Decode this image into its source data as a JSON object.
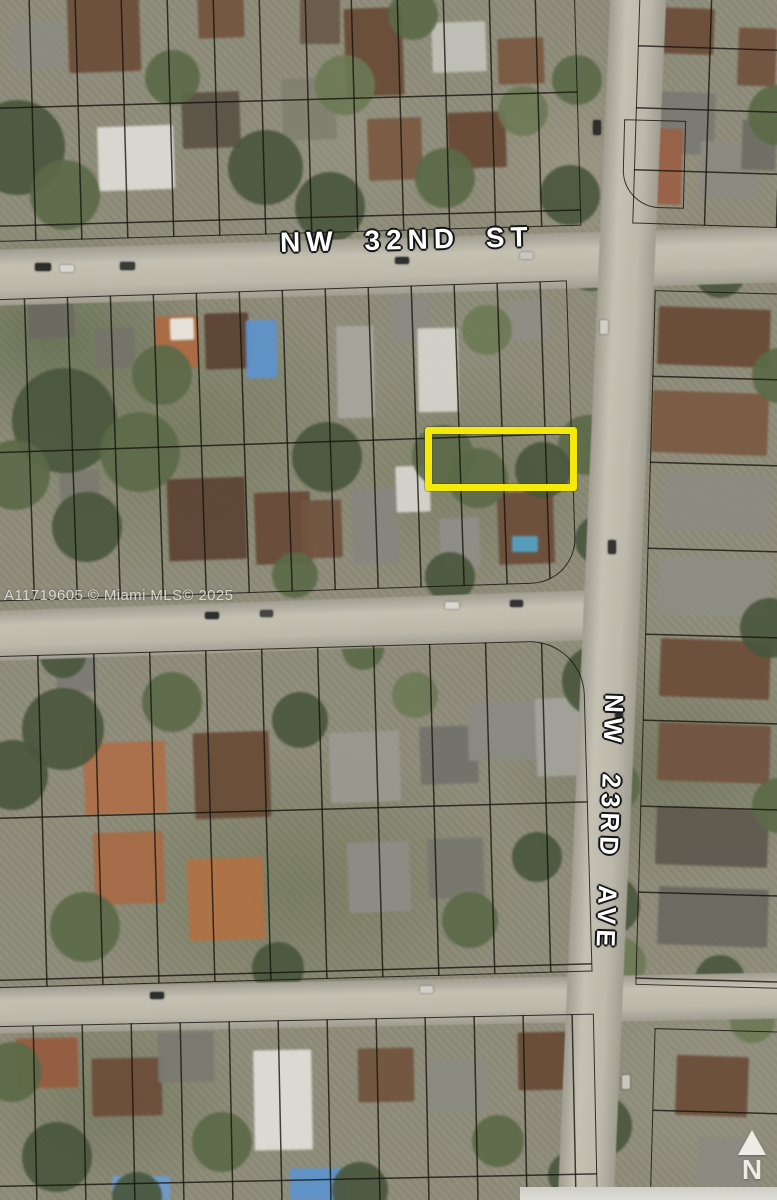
{
  "image": {
    "kind": "aerial-parcel-map",
    "width": 777,
    "height": 1200
  },
  "labels": {
    "street_horizontal": "NW 32ND ST",
    "street_vertical": "NW 23RD AVE",
    "watermark": "A11719605 © Miami MLS© 2025",
    "north_indicator": "N"
  },
  "colors": {
    "highlight_yellow": "#F5E90A",
    "parcel_line": "rgba(20,18,12,0.82)",
    "road_gray": "#bcb9ab",
    "label_white": "#ffffff"
  },
  "highlight": {
    "x": 425,
    "y": 427,
    "w": 152,
    "h": 64,
    "border_px": 7,
    "color": "#F5E90A"
  },
  "scene": {
    "roads": [
      {
        "x": -20,
        "y": 238,
        "w": 820,
        "h": 56,
        "rot": -1.7,
        "vert": false
      },
      {
        "x": -20,
        "y": 600,
        "w": 655,
        "h": 50,
        "rot": -2.0,
        "vert": false
      },
      {
        "x": -20,
        "y": 980,
        "w": 820,
        "h": 46,
        "rot": -1.1,
        "vert": false
      },
      {
        "x": 584,
        "y": -45,
        "w": 56,
        "h": 1290,
        "rot": 2.5,
        "vert": true
      }
    ],
    "blocks": [
      {
        "x": -14,
        "y": -18,
        "w": 592,
        "h": 252,
        "rot": -1.6,
        "v": 46,
        "h2": 118
      },
      {
        "x": 636,
        "y": -14,
        "w": 158,
        "h": 240,
        "rot": 1.8,
        "v": 72,
        "h2": 62
      },
      {
        "x": 623,
        "y": 120,
        "w": 62,
        "h": 88,
        "rot": 1.5,
        "v": 0,
        "h2": 0,
        "rbl": 38
      },
      {
        "x": -14,
        "y": 290,
        "w": 586,
        "h": 302,
        "rot": -1.9,
        "v": 43,
        "h2": 153,
        "rbr": 45
      },
      {
        "x": 645,
        "y": 292,
        "w": 148,
        "h": 695,
        "rot": 1.6,
        "v": 0,
        "h2": 86
      },
      {
        "x": -14,
        "y": 648,
        "w": 602,
        "h": 332,
        "rot": -1.6,
        "v": 56,
        "h2": 162,
        "rtr": 55
      },
      {
        "x": -14,
        "y": 1020,
        "w": 610,
        "h": 200,
        "rot": -1.2,
        "v": 49,
        "h2": 160
      },
      {
        "x": 652,
        "y": 1030,
        "w": 142,
        "h": 185,
        "rot": 1.6,
        "v": 0,
        "h2": 82
      }
    ],
    "houses": [
      {
        "x": 12,
        "y": 22,
        "w": 52,
        "h": 46,
        "c": "#8d8b82",
        "r": -2
      },
      {
        "x": 68,
        "y": -6,
        "w": 72,
        "h": 78,
        "c": "#6e4f38",
        "r": -2
      },
      {
        "x": 98,
        "y": 126,
        "w": 76,
        "h": 64,
        "c": "#dbdad2",
        "r": -2
      },
      {
        "x": 182,
        "y": 92,
        "w": 58,
        "h": 56,
        "c": "#5d5346",
        "r": -2
      },
      {
        "x": 198,
        "y": -4,
        "w": 46,
        "h": 42,
        "c": "#77553c",
        "r": -2
      },
      {
        "x": 282,
        "y": 78,
        "w": 54,
        "h": 62,
        "c": "#82816f",
        "r": -2
      },
      {
        "x": 300,
        "y": -6,
        "w": 40,
        "h": 50,
        "c": "#6b5a49",
        "r": 0
      },
      {
        "x": 345,
        "y": 8,
        "w": 58,
        "h": 88,
        "c": "#6b4c36",
        "r": -2
      },
      {
        "x": 368,
        "y": 118,
        "w": 54,
        "h": 62,
        "c": "#7d5b41",
        "r": -2
      },
      {
        "x": 432,
        "y": 22,
        "w": 54,
        "h": 50,
        "c": "#c2c1b8",
        "r": -2
      },
      {
        "x": 448,
        "y": 112,
        "w": 58,
        "h": 56,
        "c": "#6a4a34",
        "r": -2
      },
      {
        "x": 498,
        "y": 38,
        "w": 46,
        "h": 46,
        "c": "#7c5a40",
        "r": -2
      },
      {
        "x": 652,
        "y": 8,
        "w": 62,
        "h": 46,
        "c": "#6e4e38",
        "r": 2
      },
      {
        "x": 645,
        "y": 92,
        "w": 70,
        "h": 62,
        "c": "#7b7a71",
        "r": 2
      },
      {
        "x": 624,
        "y": 128,
        "w": 58,
        "h": 76,
        "c": "#9d6044",
        "r": 2
      },
      {
        "x": 738,
        "y": 28,
        "w": 38,
        "h": 58,
        "c": "#74533c",
        "r": 2
      },
      {
        "x": 700,
        "y": 142,
        "w": 58,
        "h": 56,
        "c": "#8b8a80",
        "r": 2
      },
      {
        "x": 742,
        "y": 120,
        "w": 34,
        "h": 50,
        "c": "#6f6e64",
        "r": 2
      },
      {
        "x": 28,
        "y": 298,
        "w": 46,
        "h": 40,
        "c": "#6b6a60",
        "r": -2
      },
      {
        "x": 95,
        "y": 328,
        "w": 40,
        "h": 40,
        "c": "#757468",
        "r": -2
      },
      {
        "x": 155,
        "y": 316,
        "w": 44,
        "h": 52,
        "c": "#b06a3f",
        "r": -2
      },
      {
        "x": 170,
        "y": 318,
        "w": 24,
        "h": 22,
        "c": "#e9e7df",
        "r": -2
      },
      {
        "x": 205,
        "y": 313,
        "w": 44,
        "h": 56,
        "c": "#5e4432",
        "r": -2
      },
      {
        "x": 246,
        "y": 320,
        "w": 31,
        "h": 58,
        "c": "#5b93cf",
        "r": -1
      },
      {
        "x": 337,
        "y": 326,
        "w": 37,
        "h": 92,
        "c": "#a7a69c",
        "r": -1
      },
      {
        "x": 390,
        "y": 298,
        "w": 40,
        "h": 44,
        "c": "#8b8a82",
        "r": -2
      },
      {
        "x": 418,
        "y": 328,
        "w": 40,
        "h": 84,
        "c": "#d3d2ca",
        "r": -1
      },
      {
        "x": 508,
        "y": 300,
        "w": 40,
        "h": 40,
        "c": "#8f8e84",
        "r": -2
      },
      {
        "x": 168,
        "y": 478,
        "w": 78,
        "h": 82,
        "c": "#5f4533",
        "r": -2
      },
      {
        "x": 255,
        "y": 492,
        "w": 56,
        "h": 72,
        "c": "#6b4b37",
        "r": -2
      },
      {
        "x": 302,
        "y": 500,
        "w": 40,
        "h": 58,
        "c": "#74543e",
        "r": -2
      },
      {
        "x": 352,
        "y": 488,
        "w": 46,
        "h": 76,
        "c": "#87867e",
        "r": -2
      },
      {
        "x": 396,
        "y": 466,
        "w": 34,
        "h": 46,
        "c": "#d5d4cc",
        "r": -2
      },
      {
        "x": 440,
        "y": 518,
        "w": 40,
        "h": 50,
        "c": "#8f8e86",
        "r": -2
      },
      {
        "x": 498,
        "y": 492,
        "w": 56,
        "h": 72,
        "c": "#6e4e38",
        "r": -2
      },
      {
        "x": 512,
        "y": 536,
        "w": 26,
        "h": 16,
        "c": "#4fa0c4",
        "r": 0
      },
      {
        "x": 60,
        "y": 470,
        "w": 40,
        "h": 40,
        "c": "#7a7a6e",
        "r": -2
      },
      {
        "x": 658,
        "y": 308,
        "w": 112,
        "h": 58,
        "c": "#6b4b35",
        "r": 2
      },
      {
        "x": 652,
        "y": 392,
        "w": 116,
        "h": 62,
        "c": "#7d5a3f",
        "r": 2
      },
      {
        "x": 664,
        "y": 474,
        "w": 106,
        "h": 58,
        "c": "#8b8b81",
        "r": 2
      },
      {
        "x": 658,
        "y": 558,
        "w": 112,
        "h": 58,
        "c": "#8f8e84",
        "r": 2
      },
      {
        "x": 660,
        "y": 640,
        "w": 110,
        "h": 58,
        "c": "#6e4e38",
        "r": 2
      },
      {
        "x": 658,
        "y": 724,
        "w": 112,
        "h": 58,
        "c": "#745440",
        "r": 2
      },
      {
        "x": 656,
        "y": 808,
        "w": 112,
        "h": 58,
        "c": "#60594e",
        "r": 2
      },
      {
        "x": 658,
        "y": 888,
        "w": 110,
        "h": 58,
        "c": "#6b6a60",
        "r": 2
      },
      {
        "x": 84,
        "y": 742,
        "w": 82,
        "h": 72,
        "c": "#b06f46",
        "r": -2
      },
      {
        "x": 194,
        "y": 732,
        "w": 76,
        "h": 86,
        "c": "#6b4c36",
        "r": -2
      },
      {
        "x": 94,
        "y": 832,
        "w": 70,
        "h": 72,
        "c": "#aa6a42",
        "r": -2
      },
      {
        "x": 188,
        "y": 858,
        "w": 76,
        "h": 82,
        "c": "#b3703f",
        "r": -2
      },
      {
        "x": 330,
        "y": 732,
        "w": 70,
        "h": 70,
        "c": "#9a9990",
        "r": -2
      },
      {
        "x": 420,
        "y": 726,
        "w": 58,
        "h": 58,
        "c": "#74736a",
        "r": -2
      },
      {
        "x": 468,
        "y": 702,
        "w": 70,
        "h": 58,
        "c": "#8b8a82",
        "r": -2
      },
      {
        "x": 536,
        "y": 698,
        "w": 50,
        "h": 78,
        "c": "#a3a29a",
        "r": -2
      },
      {
        "x": 348,
        "y": 842,
        "w": 62,
        "h": 70,
        "c": "#8d8c84",
        "r": -2
      },
      {
        "x": 428,
        "y": 838,
        "w": 56,
        "h": 60,
        "c": "#79786e",
        "r": -2
      },
      {
        "x": 56,
        "y": 648,
        "w": 40,
        "h": 44,
        "c": "#7c7b72",
        "r": -2
      },
      {
        "x": 16,
        "y": 1038,
        "w": 62,
        "h": 50,
        "c": "#9a5c3d",
        "r": -1
      },
      {
        "x": 92,
        "y": 1058,
        "w": 70,
        "h": 58,
        "c": "#6e4e38",
        "r": -1
      },
      {
        "x": 158,
        "y": 1032,
        "w": 56,
        "h": 50,
        "c": "#7b7a70",
        "r": -1
      },
      {
        "x": 254,
        "y": 1050,
        "w": 58,
        "h": 100,
        "c": "#deddd5",
        "r": -1
      },
      {
        "x": 112,
        "y": 1176,
        "w": 58,
        "h": 24,
        "c": "#6a9bd0",
        "r": 0
      },
      {
        "x": 290,
        "y": 1168,
        "w": 55,
        "h": 32,
        "c": "#5b93cf",
        "r": 0
      },
      {
        "x": 358,
        "y": 1048,
        "w": 56,
        "h": 54,
        "c": "#74543c",
        "r": -1
      },
      {
        "x": 428,
        "y": 1058,
        "w": 60,
        "h": 54,
        "c": "#8b8a80",
        "r": -1
      },
      {
        "x": 518,
        "y": 1032,
        "w": 56,
        "h": 58,
        "c": "#6b4b35",
        "r": -1
      },
      {
        "x": 676,
        "y": 1056,
        "w": 72,
        "h": 60,
        "c": "#6e4e38",
        "r": 2
      },
      {
        "x": 698,
        "y": 1138,
        "w": 62,
        "h": 48,
        "c": "#8a8a80",
        "r": 2
      }
    ],
    "trees": [
      {
        "x": -30,
        "y": 100,
        "d": 95,
        "t": 0
      },
      {
        "x": 30,
        "y": 160,
        "d": 70,
        "t": 1
      },
      {
        "x": 145,
        "y": 50,
        "d": 55,
        "t": 1
      },
      {
        "x": 228,
        "y": 130,
        "d": 75,
        "t": 0
      },
      {
        "x": 315,
        "y": 55,
        "d": 60,
        "t": 2
      },
      {
        "x": 295,
        "y": 172,
        "d": 70,
        "t": 0
      },
      {
        "x": 415,
        "y": 148,
        "d": 60,
        "t": 1
      },
      {
        "x": 498,
        "y": 86,
        "d": 50,
        "t": 2
      },
      {
        "x": 540,
        "y": 165,
        "d": 60,
        "t": 0
      },
      {
        "x": 388,
        "y": -10,
        "d": 50,
        "t": 1
      },
      {
        "x": 552,
        "y": 55,
        "d": 50,
        "t": 1
      },
      {
        "x": 568,
        "y": 245,
        "d": 46,
        "t": 0
      },
      {
        "x": 558,
        "y": 415,
        "d": 60,
        "t": 1
      },
      {
        "x": 575,
        "y": 515,
        "d": 50,
        "t": 0
      },
      {
        "x": 562,
        "y": 645,
        "d": 72,
        "t": 0
      },
      {
        "x": 585,
        "y": 758,
        "d": 55,
        "t": 1
      },
      {
        "x": 580,
        "y": 875,
        "d": 60,
        "t": 0
      },
      {
        "x": 596,
        "y": 938,
        "d": 50,
        "t": 2
      },
      {
        "x": 570,
        "y": 1095,
        "d": 62,
        "t": 0
      },
      {
        "x": 748,
        "y": 85,
        "d": 60,
        "t": 1
      },
      {
        "x": 695,
        "y": 248,
        "d": 50,
        "t": 0
      },
      {
        "x": 752,
        "y": 348,
        "d": 55,
        "t": 1
      },
      {
        "x": 740,
        "y": 598,
        "d": 60,
        "t": 0
      },
      {
        "x": 752,
        "y": 778,
        "d": 55,
        "t": 1
      },
      {
        "x": 695,
        "y": 955,
        "d": 50,
        "t": 0
      },
      {
        "x": 730,
        "y": 998,
        "d": 45,
        "t": 2
      },
      {
        "x": 12,
        "y": 368,
        "d": 105,
        "t": 0
      },
      {
        "x": 100,
        "y": 412,
        "d": 80,
        "t": 1
      },
      {
        "x": 52,
        "y": 492,
        "d": 70,
        "t": 0
      },
      {
        "x": 132,
        "y": 345,
        "d": 60,
        "t": 1
      },
      {
        "x": 292,
        "y": 422,
        "d": 70,
        "t": 0
      },
      {
        "x": 412,
        "y": 425,
        "d": 62,
        "t": 1
      },
      {
        "x": 462,
        "y": 305,
        "d": 50,
        "t": 2
      },
      {
        "x": 515,
        "y": 442,
        "d": 56,
        "t": 0
      },
      {
        "x": 448,
        "y": 448,
        "d": 60,
        "t": 1
      },
      {
        "x": 425,
        "y": 552,
        "d": 50,
        "t": 0
      },
      {
        "x": 272,
        "y": 552,
        "d": 46,
        "t": 1
      },
      {
        "x": 22,
        "y": 688,
        "d": 82,
        "t": 0
      },
      {
        "x": 142,
        "y": 672,
        "d": 60,
        "t": 1
      },
      {
        "x": 272,
        "y": 692,
        "d": 56,
        "t": 0
      },
      {
        "x": 50,
        "y": 892,
        "d": 70,
        "t": 1
      },
      {
        "x": 252,
        "y": 942,
        "d": 52,
        "t": 0
      },
      {
        "x": 442,
        "y": 892,
        "d": 56,
        "t": 1
      },
      {
        "x": 512,
        "y": 832,
        "d": 50,
        "t": 0
      },
      {
        "x": 392,
        "y": 672,
        "d": 46,
        "t": 2
      },
      {
        "x": 22,
        "y": 1122,
        "d": 70,
        "t": 0
      },
      {
        "x": 192,
        "y": 1112,
        "d": 60,
        "t": 1
      },
      {
        "x": 332,
        "y": 1162,
        "d": 56,
        "t": 0
      },
      {
        "x": 472,
        "y": 1115,
        "d": 52,
        "t": 1
      },
      {
        "x": 548,
        "y": 1152,
        "d": 46,
        "t": 0
      },
      {
        "x": 112,
        "y": 1172,
        "d": 50,
        "t": 0
      },
      {
        "x": 342,
        "y": 628,
        "d": 42,
        "t": 1
      },
      {
        "x": 40,
        "y": 632,
        "d": 46,
        "t": 0
      },
      {
        "x": -20,
        "y": 440,
        "d": 70,
        "t": 1
      },
      {
        "x": -22,
        "y": 740,
        "d": 70,
        "t": 0
      },
      {
        "x": -18,
        "y": 1042,
        "d": 60,
        "t": 1
      }
    ],
    "cars": [
      {
        "x": 35,
        "y": 263,
        "w": 16,
        "h": 8,
        "c": "#2e2e2c"
      },
      {
        "x": 60,
        "y": 265,
        "w": 14,
        "h": 7,
        "c": "#d8d7d0"
      },
      {
        "x": 120,
        "y": 262,
        "w": 15,
        "h": 8,
        "c": "#3a3a38"
      },
      {
        "x": 395,
        "y": 257,
        "w": 14,
        "h": 7,
        "c": "#303030"
      },
      {
        "x": 520,
        "y": 252,
        "w": 13,
        "h": 7,
        "c": "#c8c7c0"
      },
      {
        "x": 593,
        "y": 120,
        "w": 8,
        "h": 15,
        "c": "#2e2e2c"
      },
      {
        "x": 600,
        "y": 320,
        "w": 8,
        "h": 14,
        "c": "#d0cfc8"
      },
      {
        "x": 608,
        "y": 540,
        "w": 8,
        "h": 14,
        "c": "#343434"
      },
      {
        "x": 615,
        "y": 705,
        "w": 8,
        "h": 14,
        "c": "#2a2a28"
      },
      {
        "x": 622,
        "y": 1075,
        "w": 8,
        "h": 14,
        "c": "#c8c7c0"
      },
      {
        "x": 205,
        "y": 612,
        "w": 14,
        "h": 7,
        "c": "#2e2e2c"
      },
      {
        "x": 260,
        "y": 610,
        "w": 13,
        "h": 7,
        "c": "#444442"
      },
      {
        "x": 445,
        "y": 602,
        "w": 14,
        "h": 7,
        "c": "#d8d7d0"
      },
      {
        "x": 510,
        "y": 600,
        "w": 13,
        "h": 7,
        "c": "#333331"
      },
      {
        "x": 150,
        "y": 992,
        "w": 14,
        "h": 7,
        "c": "#2e2e2c"
      },
      {
        "x": 420,
        "y": 986,
        "w": 13,
        "h": 7,
        "c": "#d0cfc8"
      }
    ],
    "tree_palette": [
      "#49573b",
      "#5a6a45",
      "#6d7a52"
    ]
  }
}
